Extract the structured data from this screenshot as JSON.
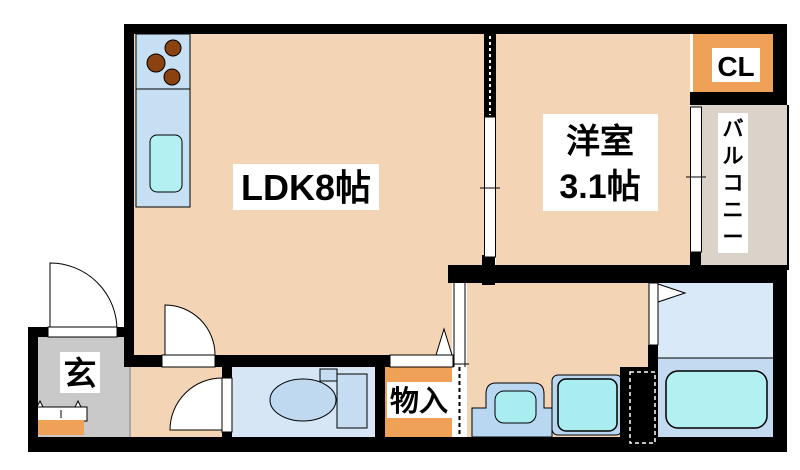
{
  "canvas": {
    "width": 800,
    "height": 470,
    "background": "#ffffff"
  },
  "palette": {
    "wall": "#000000",
    "room_peach": "#F3D5B6",
    "closet_orange": "#F0A158",
    "balcony_gray": "#DBD3CA",
    "entrance_gray": "#C9C9C9",
    "kitchen_blue": "#C7DFF2",
    "fixture_cyan": "#B3F0F2",
    "toilet_floor_blue": "#D7E6F5",
    "bath_upper_blue": "#D9E9F8",
    "bath_lower_blue": "#C3DAF1",
    "label_bg": "#FFFFFF",
    "burner_brown": "#8A4210"
  },
  "rooms": [
    {
      "name": "room-ldk",
      "shape": "rect",
      "x": 133,
      "y": 34,
      "w": 351,
      "h": 233,
      "fill": "#F3D5B6"
    },
    {
      "name": "room-ldk-lower",
      "shape": "rect",
      "x": 133,
      "y": 255,
      "w": 320,
      "h": 102,
      "fill": "#F3D5B6"
    },
    {
      "name": "room-western",
      "shape": "rect",
      "x": 496,
      "y": 34,
      "w": 194,
      "h": 233,
      "fill": "#F3D5B6"
    },
    {
      "name": "closet-cl",
      "shape": "rect",
      "x": 693,
      "y": 33,
      "w": 80,
      "h": 60,
      "fill": "#F0A158"
    },
    {
      "name": "balcony",
      "shape": "rect",
      "x": 691,
      "y": 105,
      "w": 97,
      "h": 164,
      "fill": "#DBD3CA"
    },
    {
      "name": "entrance-genkan",
      "shape": "rect",
      "x": 38,
      "y": 337,
      "w": 92,
      "h": 100,
      "fill": "#C9C9C9"
    },
    {
      "name": "hallway",
      "shape": "rect",
      "x": 130,
      "y": 367,
      "w": 92,
      "h": 70,
      "fill": "#F3D5B6"
    },
    {
      "name": "toilet-room",
      "shape": "rect",
      "x": 232,
      "y": 367,
      "w": 143,
      "h": 70,
      "fill": "#D7E6F5"
    },
    {
      "name": "storage-mononire",
      "shape": "rect",
      "x": 385,
      "y": 363,
      "w": 70,
      "h": 74,
      "fill": "#F0A158"
    },
    {
      "name": "washroom",
      "shape": "rect",
      "x": 467,
      "y": 283,
      "w": 182,
      "h": 154,
      "fill": "#F3D5B6"
    },
    {
      "name": "bathroom-upper",
      "shape": "rect",
      "x": 658,
      "y": 283,
      "w": 115,
      "h": 75,
      "fill": "#D9E9F8"
    },
    {
      "name": "bathroom-lower",
      "shape": "rect",
      "x": 658,
      "y": 358,
      "w": 115,
      "h": 79,
      "fill": "#C3DAF1"
    }
  ],
  "fixtures": [
    {
      "name": "kitchen-counter",
      "shape": "rect",
      "x": 136,
      "y": 34,
      "w": 54,
      "h": 173,
      "fill": "#C7DFF2",
      "stroke": "#000",
      "sw": 1
    },
    {
      "name": "kitchen-divider",
      "shape": "line",
      "x1": 136,
      "y1": 89,
      "x2": 190,
      "y2": 89,
      "stroke": "#000",
      "sw": 1
    },
    {
      "name": "stove-burner-1",
      "shape": "circle",
      "cx": 173,
      "cy": 48,
      "r": 8,
      "fill": "#8A4210",
      "stroke": "#000",
      "sw": 1
    },
    {
      "name": "stove-burner-2",
      "shape": "circle",
      "cx": 156,
      "cy": 63,
      "r": 9,
      "fill": "#8A4210",
      "stroke": "#000",
      "sw": 1
    },
    {
      "name": "stove-burner-3",
      "shape": "circle",
      "cx": 172,
      "cy": 77,
      "r": 8,
      "fill": "#8A4210",
      "stroke": "#000",
      "sw": 1
    },
    {
      "name": "kitchen-sink",
      "shape": "rect",
      "x": 150,
      "y": 135,
      "w": 32,
      "h": 57,
      "rx": 7,
      "fill": "#B3F0F2",
      "stroke": "#000",
      "sw": 1
    },
    {
      "name": "toilet-tank",
      "shape": "rect",
      "x": 337,
      "y": 374,
      "w": 30,
      "h": 54,
      "fill": "#C6DCF2",
      "stroke": "#000",
      "sw": 1
    },
    {
      "name": "toilet-flush-box",
      "shape": "rect",
      "x": 320,
      "y": 369,
      "w": 17,
      "h": 12,
      "fill": "#C6DCF2",
      "stroke": "#000",
      "sw": 1
    },
    {
      "name": "toilet-bowl",
      "shape": "ellipse",
      "cx": 303,
      "cy": 400,
      "rx": 33,
      "ry": 21,
      "fill": "#BFD9F0",
      "stroke": "#000",
      "sw": 1
    },
    {
      "name": "washbasin-counter",
      "shape": "path",
      "d": "M472,437 L472,408 L486,408 L486,394 Q486,383 496,383 L534,383 Q544,383 544,394 L544,408 L552,408 L552,437 Z",
      "fill": "#B9D7F1",
      "stroke": "#000",
      "sw": 1
    },
    {
      "name": "washbasin-bowl",
      "shape": "rect",
      "x": 495,
      "y": 391,
      "w": 41,
      "h": 32,
      "rx": 9,
      "fill": "#A9EDF0",
      "stroke": "#000",
      "sw": 1
    },
    {
      "name": "washing-machine-pan",
      "shape": "rect",
      "x": 552,
      "y": 375,
      "w": 70,
      "h": 60,
      "rx": 6,
      "fill": "#B9D7F1",
      "stroke": "#000",
      "sw": 1
    },
    {
      "name": "washing-machine",
      "shape": "rect",
      "x": 558,
      "y": 379,
      "w": 59,
      "h": 52,
      "rx": 8,
      "fill": "#A9EDF0",
      "stroke": "#000",
      "sw": 1.5
    },
    {
      "name": "bathtub",
      "shape": "rect",
      "x": 666,
      "y": 371,
      "w": 101,
      "h": 57,
      "rx": 12,
      "fill": "#B3F0F2",
      "stroke": "#000",
      "sw": 1.5
    },
    {
      "name": "bathroom-floor-line",
      "shape": "line",
      "x1": 658,
      "y1": 358,
      "x2": 773,
      "y2": 358,
      "stroke": "#000",
      "sw": 1
    },
    {
      "name": "shoe-cabinet",
      "shape": "rect",
      "x": 36,
      "y": 407,
      "w": 51,
      "h": 14,
      "fill": "#FFFFFF",
      "stroke": "#000",
      "sw": 1
    },
    {
      "name": "shoe-cabinet-handle",
      "shape": "line",
      "x1": 61,
      "y1": 410,
      "x2": 61,
      "y2": 418,
      "stroke": "#000",
      "sw": 1
    },
    {
      "name": "cabinet-hook-left",
      "shape": "polygon",
      "points": "37,407 43,407 40,401",
      "fill": "#FFFFFF",
      "stroke": "#000",
      "sw": 1
    },
    {
      "name": "cabinet-hook-right",
      "shape": "polygon",
      "points": "75,407 81,407 78,401",
      "fill": "#FFFFFF",
      "stroke": "#000",
      "sw": 1
    },
    {
      "name": "entrance-step",
      "shape": "rect",
      "x": 38,
      "y": 420,
      "w": 46,
      "h": 15,
      "fill": "#F0A158"
    },
    {
      "name": "entrance-floor-edge",
      "shape": "line",
      "x1": 130,
      "y1": 367,
      "x2": 130,
      "y2": 437,
      "stroke": "#9A9A9A",
      "sw": 1.5
    }
  ],
  "walls": [
    {
      "name": "wall-top",
      "shape": "rect",
      "x": 124,
      "y": 24,
      "w": 663,
      "h": 10
    },
    {
      "name": "wall-left",
      "shape": "rect",
      "x": 124,
      "y": 24,
      "w": 10,
      "h": 343
    },
    {
      "name": "wall-right-upper",
      "shape": "rect",
      "x": 773,
      "y": 24,
      "w": 14,
      "h": 81
    },
    {
      "name": "wall-cl-bottom",
      "shape": "rect",
      "x": 690,
      "y": 92,
      "w": 97,
      "h": 13
    },
    {
      "name": "wall-partition-top",
      "shape": "rect",
      "x": 484,
      "y": 34,
      "w": 12,
      "h": 83
    },
    {
      "name": "wall-partition-stub",
      "shape": "rect",
      "x": 482,
      "y": 255,
      "w": 13,
      "h": 30
    },
    {
      "name": "wall-waterarea-top",
      "shape": "rect",
      "x": 448,
      "y": 265,
      "w": 339,
      "h": 18
    },
    {
      "name": "wall-right-lower",
      "shape": "rect",
      "x": 773,
      "y": 265,
      "w": 14,
      "h": 187
    },
    {
      "name": "wall-bottom",
      "shape": "rect",
      "x": 28,
      "y": 437,
      "w": 759,
      "h": 15
    },
    {
      "name": "wall-ldk-bottom",
      "shape": "rect",
      "x": 124,
      "y": 355,
      "w": 333,
      "h": 12
    },
    {
      "name": "wall-toilet-left",
      "shape": "rect",
      "x": 222,
      "y": 367,
      "w": 10,
      "h": 70
    },
    {
      "name": "wall-toilet-right",
      "shape": "rect",
      "x": 375,
      "y": 363,
      "w": 10,
      "h": 74
    },
    {
      "name": "wall-entrance-top",
      "shape": "rect",
      "x": 28,
      "y": 327,
      "w": 96,
      "h": 10
    },
    {
      "name": "wall-entrance-left",
      "shape": "rect",
      "x": 28,
      "y": 327,
      "w": 10,
      "h": 125
    },
    {
      "name": "wall-bathdoor-stub",
      "shape": "rect",
      "x": 648,
      "y": 345,
      "w": 10,
      "h": 22
    },
    {
      "name": "wall-bath-service",
      "shape": "rect",
      "x": 620,
      "y": 367,
      "w": 38,
      "h": 78
    },
    {
      "name": "wall-balcony-stub",
      "shape": "rect",
      "x": 690,
      "y": 252,
      "w": 11,
      "h": 16
    }
  ],
  "openings": [
    {
      "name": "partition-pocket-dash",
      "shape": "line",
      "x1": 490,
      "y1": 36,
      "x2": 490,
      "y2": 115,
      "stroke": "#FFFFFF",
      "sw": 2,
      "dash": "3,3"
    },
    {
      "name": "sliding-door-panel",
      "shape": "rect",
      "x": 484.5,
      "y": 117,
      "w": 11,
      "h": 140,
      "fill": "#FFFFFF",
      "stroke": "#000",
      "sw": 1
    },
    {
      "name": "sliding-door-tick",
      "shape": "line",
      "x1": 480,
      "y1": 188,
      "x2": 500,
      "y2": 188,
      "stroke": "#000",
      "sw": 1
    },
    {
      "name": "western-window",
      "shape": "rect",
      "x": 690.5,
      "y": 107,
      "w": 11,
      "h": 145,
      "fill": "#FFFFFF",
      "stroke": "#000",
      "sw": 1
    },
    {
      "name": "western-window-tick",
      "shape": "line",
      "x1": 686,
      "y1": 177,
      "x2": 706,
      "y2": 177,
      "stroke": "#000",
      "sw": 1
    },
    {
      "name": "washroom-slide-track",
      "shape": "rect",
      "x": 452,
      "y": 283,
      "w": 15,
      "h": 154,
      "fill": "#FFFFFF"
    },
    {
      "name": "washroom-slide-left",
      "shape": "line",
      "x1": 454,
      "y1": 283,
      "x2": 454,
      "y2": 367,
      "stroke": "#000",
      "sw": 1
    },
    {
      "name": "washroom-slide-right",
      "shape": "line",
      "x1": 465,
      "y1": 283,
      "x2": 465,
      "y2": 367,
      "stroke": "#000",
      "sw": 1
    },
    {
      "name": "washroom-slide-dash",
      "shape": "line",
      "x1": 459.5,
      "y1": 367,
      "x2": 459.5,
      "y2": 437,
      "stroke": "#000",
      "sw": 2,
      "dash": "4,3"
    },
    {
      "name": "washroom-slide-tick",
      "shape": "line",
      "x1": 449,
      "y1": 364,
      "x2": 469,
      "y2": 364,
      "stroke": "#000",
      "sw": 1
    },
    {
      "name": "ldk-door-swing",
      "shape": "path",
      "d": "M165,355 L165,305 A50,50 0 0 1 215,355 Z",
      "fill": "#FFFFFF",
      "stroke": "#000",
      "sw": 1
    },
    {
      "name": "ldk-door-leaf",
      "shape": "rect",
      "x": 162,
      "y": 355,
      "w": 53,
      "h": 12,
      "fill": "#FFFFFF",
      "stroke": "#000",
      "sw": 1
    },
    {
      "name": "entrance-door-swing",
      "shape": "path",
      "d": "M50,330 L50,263 A67,67 0 0 1 117,330 Z",
      "fill": "#FFFFFF",
      "stroke": "#000",
      "sw": 1
    },
    {
      "name": "entrance-door-leaf",
      "shape": "rect",
      "x": 48,
      "y": 327,
      "w": 69,
      "h": 10,
      "fill": "#FFFFFF",
      "stroke": "#000",
      "sw": 1
    },
    {
      "name": "toilet-door-swing",
      "shape": "path",
      "d": "M222,430 L222,378 A52,52 0 0 0 170,430 Z",
      "fill": "#FFFFFF",
      "stroke": "#000",
      "sw": 1
    },
    {
      "name": "toilet-door-leaf",
      "shape": "rect",
      "x": 222,
      "y": 378,
      "w": 10,
      "h": 54,
      "fill": "#FFFFFF",
      "stroke": "#000",
      "sw": 1
    },
    {
      "name": "storage-fold-door",
      "shape": "rect",
      "x": 390,
      "y": 355,
      "w": 63,
      "h": 12,
      "fill": "#FFFFFF",
      "stroke": "#000",
      "sw": 1
    },
    {
      "name": "storage-door-marker",
      "shape": "polygon",
      "points": "436,355 452,355 444,329",
      "fill": "#FFFFFF",
      "stroke": "#000",
      "sw": 1
    },
    {
      "name": "bath-door-panel",
      "shape": "rect",
      "x": 649,
      "y": 283,
      "w": 9,
      "h": 62,
      "fill": "#FFFFFF",
      "stroke": "#000",
      "sw": 1
    },
    {
      "name": "bath-door-marker",
      "shape": "polygon",
      "points": "658,284 685,293 658,302",
      "fill": "#FFFFFF",
      "stroke": "#000",
      "sw": 1
    },
    {
      "name": "service-hatch-dash",
      "shape": "rect",
      "x": 630,
      "y": 372,
      "w": 25,
      "h": 71,
      "stroke": "#FFFFFF",
      "sw": 1.5,
      "dash": "4,3"
    },
    {
      "name": "balcony-rail",
      "shape": "line",
      "x1": 788,
      "y1": 105,
      "x2": 788,
      "y2": 270,
      "stroke": "#000",
      "sw": 2
    }
  ],
  "labels": [
    {
      "name": "ldk-label-box",
      "shape": "rect",
      "x": 233,
      "y": 164,
      "w": 146,
      "h": 46,
      "fill": "#FFFFFF"
    },
    {
      "name": "ldk-label",
      "shape": "text",
      "x": 306,
      "y": 200,
      "size": 36,
      "text": "LDK8帖"
    },
    {
      "name": "western-label-box",
      "shape": "rect",
      "x": 543,
      "y": 114,
      "w": 115,
      "h": 97,
      "fill": "#FFFFFF"
    },
    {
      "name": "western-label",
      "shape": "text",
      "x": 600,
      "y": 153,
      "size": 34,
      "text": "洋室"
    },
    {
      "name": "western-size",
      "shape": "text",
      "x": 600,
      "y": 198,
      "size": 34,
      "text": "3.1帖"
    },
    {
      "name": "closet-label-box",
      "shape": "rect",
      "x": 712,
      "y": 48,
      "w": 48,
      "h": 34,
      "fill": "#FFFFFF"
    },
    {
      "name": "closet-label",
      "shape": "text",
      "x": 736,
      "y": 76,
      "size": 28,
      "text": "CL"
    },
    {
      "name": "balcony-label-box",
      "shape": "rect",
      "x": 718,
      "y": 113,
      "w": 30,
      "h": 140,
      "fill": "#FFFFFF"
    },
    {
      "name": "balcony-label",
      "shape": "vtext",
      "x": 733,
      "y": 136,
      "dy": 27,
      "size": 21,
      "text": "バルコニー"
    },
    {
      "name": "entrance-label-box",
      "shape": "rect",
      "x": 60,
      "y": 352,
      "w": 40,
      "h": 41,
      "fill": "#FFFFFF"
    },
    {
      "name": "entrance-label",
      "shape": "text",
      "x": 80,
      "y": 385,
      "size": 33,
      "text": "玄"
    },
    {
      "name": "storage-label-box",
      "shape": "rect",
      "x": 387,
      "y": 382,
      "w": 65,
      "h": 36,
      "fill": "#FFFFFF"
    },
    {
      "name": "storage-label",
      "shape": "text",
      "x": 419,
      "y": 411,
      "size": 29,
      "text": "物入"
    }
  ]
}
